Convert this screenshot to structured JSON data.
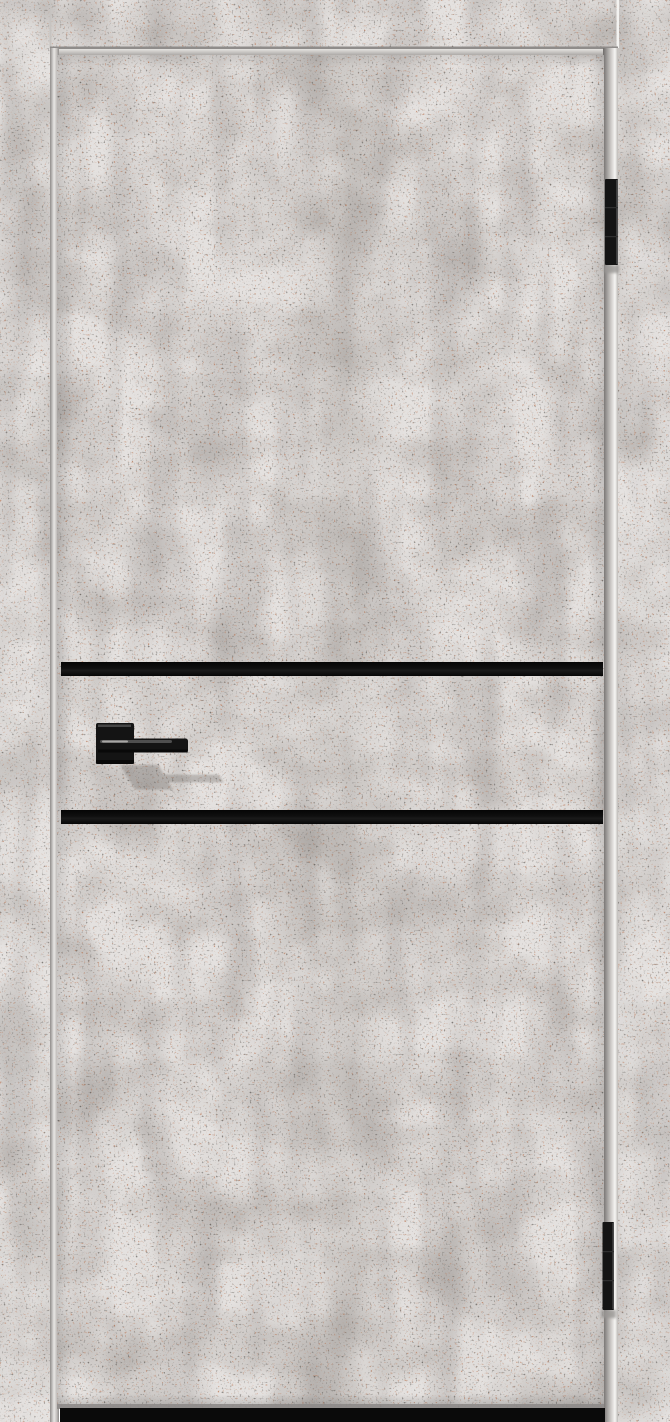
{
  "image": {
    "kind": "product-photo",
    "subject": "interior door with light gray concrete-look finish, black decorative stripes and black hardware",
    "background": "#ffffff"
  },
  "colors": {
    "concrete_base": "#e4e1df",
    "concrete_blotch": "#aaa5a1",
    "speckle_dark": "#463f3a",
    "speckle_rust": "#b56e4a",
    "stripe_black": "#0b0b0b",
    "hardware_black": "#141414",
    "seam_highlight": "#f3f2f0",
    "seam_shadow": "#8f8c8a",
    "floor_gap": "#0a0a0a",
    "shadow_gray": "#6e6965"
  },
  "door": {
    "leaf_finish": "speckled light-gray concrete laminate",
    "stripe_count": 2,
    "stripe_orientation": "horizontal",
    "hinge_count": 2,
    "hinge_side": "right",
    "handle_side": "left",
    "handle_style": "black square-rosette lever"
  }
}
